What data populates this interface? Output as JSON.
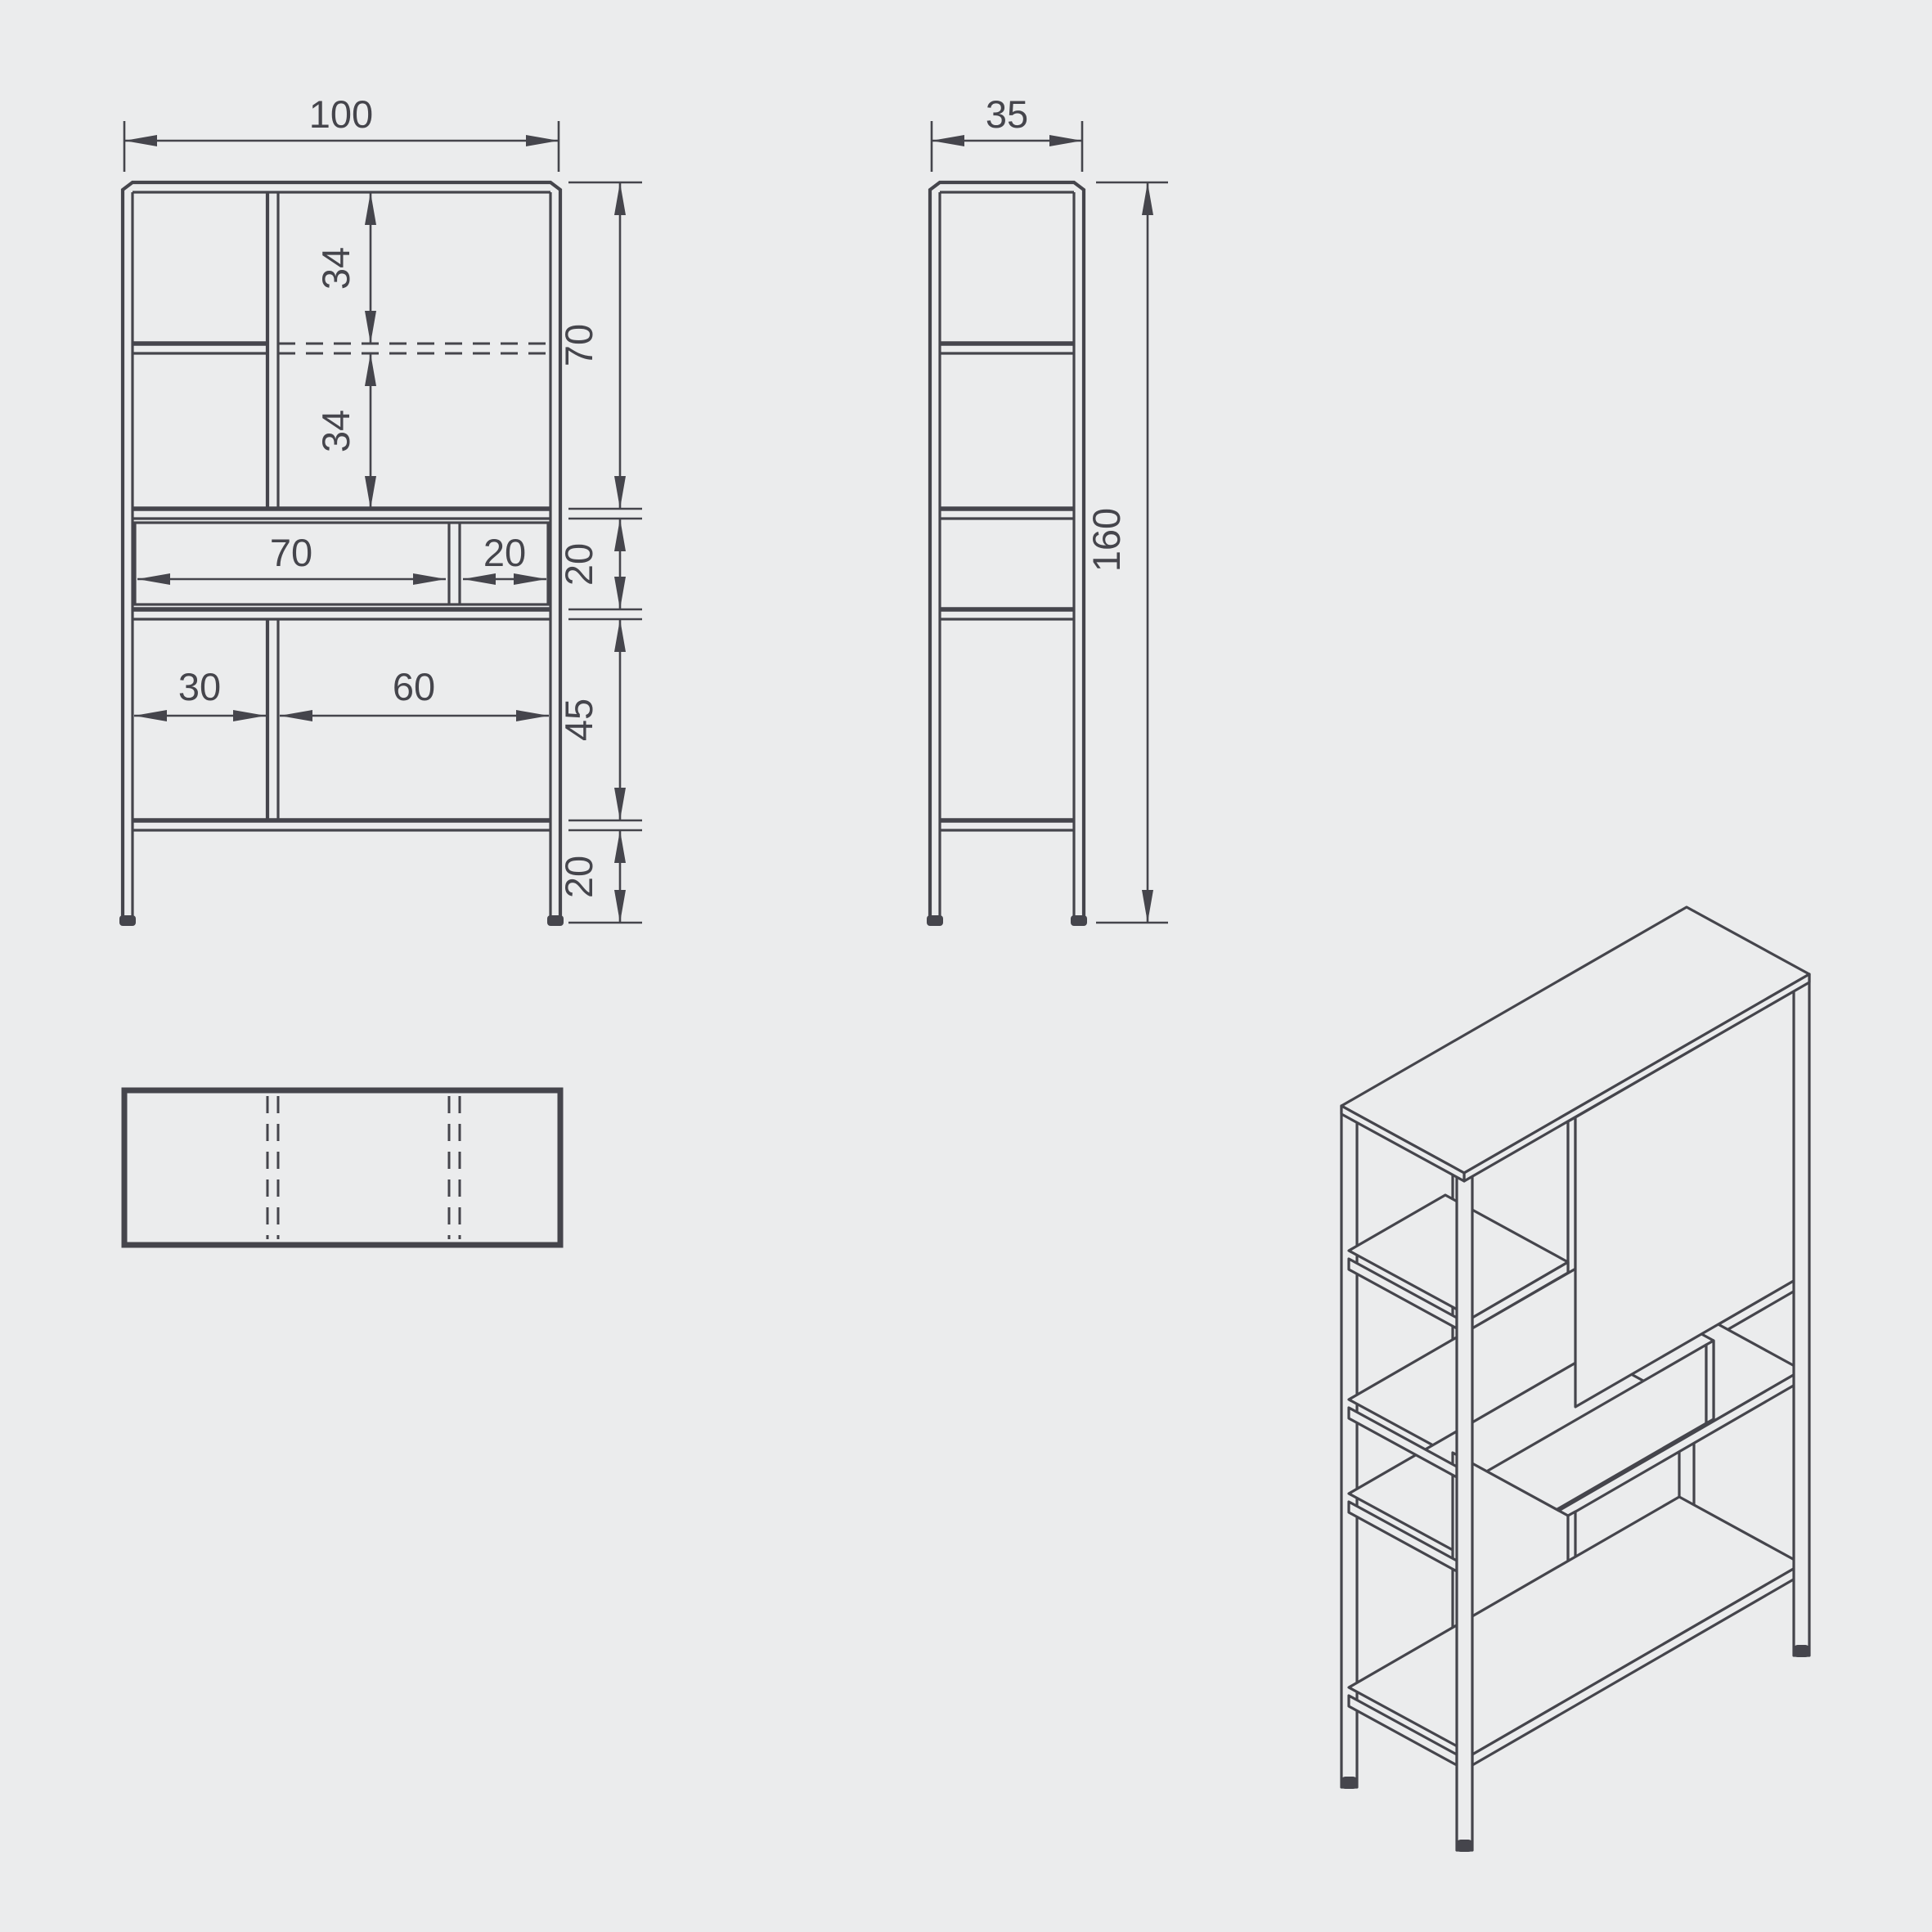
{
  "drawing": {
    "type": "furniture-technical-drawing",
    "subject": "shelving-cabinet",
    "colors": {
      "background": "#ebeced",
      "line": "#45454c",
      "text": "#45454c"
    },
    "views": {
      "front": {
        "name": "front-elevation",
        "dims": {
          "overall_width": "100",
          "upper_shelf_offset": "34",
          "lower_shelf_offset": "34",
          "top_section_height": "70",
          "drawer_row_height": "20",
          "lower_section_height": "45",
          "leg_height": "20",
          "drawer_width": "70",
          "drawer_side_width": "20",
          "lower_left_width": "30",
          "lower_right_width": "60"
        }
      },
      "side": {
        "name": "side-elevation",
        "dims": {
          "overall_depth": "35",
          "overall_height": "160"
        }
      },
      "plan": {
        "name": "top-plan-view"
      },
      "isometric": {
        "name": "isometric-view"
      }
    }
  }
}
